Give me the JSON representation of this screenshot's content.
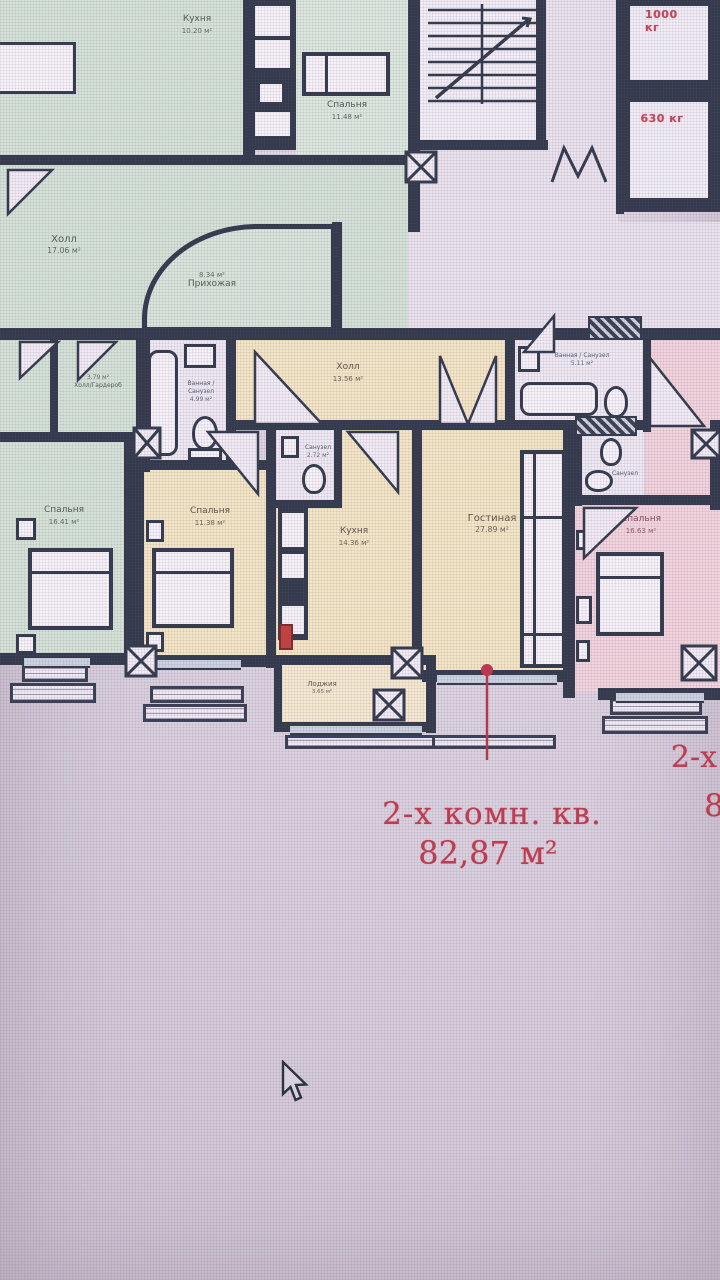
{
  "colors": {
    "annotation_red": "#c23a4c",
    "wall": "#333a4b",
    "green_room": "#d5e3d7",
    "yellow_room": "#f3e6c5",
    "pink_room": "#f2d4dc"
  },
  "plan": {
    "annotation": {
      "line1": "2-х комн. кв.",
      "line2": "82,87 м²"
    },
    "edge_annotation": {
      "line1": "2-х",
      "line2": "8"
    },
    "elevators": {
      "large": "1000 кг",
      "small": "630 кг"
    },
    "green_apartment": {
      "kitchen": {
        "name": "Кухня",
        "area": "10.20 м²"
      },
      "bedroom_top": {
        "name": "Спальня",
        "area": "11.48 м²"
      },
      "hall": {
        "name": "Холл",
        "area": "17.06 м²"
      },
      "entry": {
        "name": "Прихожая",
        "area": "8.34 м²"
      },
      "wardrobe": {
        "name": "Холл/Гардероб",
        "area": "3.79 м²"
      },
      "bedroom": {
        "name": "Спальня",
        "area": "16.41 м²"
      }
    },
    "yellow_apartment": {
      "hall": {
        "name": "Холл",
        "area": "13.56 м²"
      },
      "bathroom": {
        "name_line1": "Ванная /",
        "name_line2": "Санузел",
        "area": "4.99 м²"
      },
      "wc": {
        "name": "Санузел",
        "area": "2.72 м²"
      },
      "kitchen": {
        "name": "Кухня",
        "area": "14.36 м²"
      },
      "bedroom": {
        "name": "Спальня",
        "area": "11.38 м²"
      },
      "living": {
        "name": "Гостиная",
        "area": "27.89 м²"
      },
      "loggia": {
        "name": "Лоджия",
        "area": "3.65 м²"
      }
    },
    "pink_apartment": {
      "bathroom": {
        "name": "Ванная / Санузел",
        "area": "5.11 м²"
      },
      "wc": {
        "name": "Санузел"
      },
      "bedroom": {
        "name": "Спальня",
        "area": "16.63 м²"
      }
    }
  }
}
